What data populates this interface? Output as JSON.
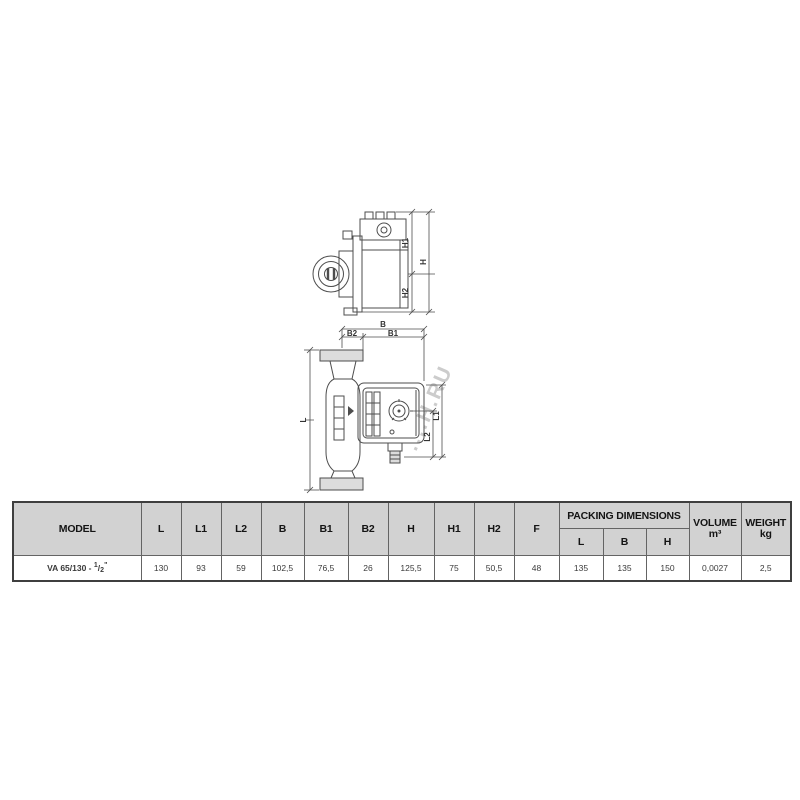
{
  "watermark": {
    "text": "....Н.RU"
  },
  "diagrams": {
    "side_view": {
      "h": "H",
      "h1": "H1",
      "h2": "H2"
    },
    "front_view": {
      "b": "B",
      "b1": "B1",
      "b2": "B2",
      "l": "L",
      "l1": "L1",
      "l2": "L2"
    }
  },
  "table": {
    "model_header": "MODEL",
    "dim_headers": [
      "L",
      "L1",
      "L2",
      "B",
      "B1",
      "B2",
      "H",
      "H1",
      "H2",
      "F"
    ],
    "packing_title": "PACKING DIMENSIONS",
    "packing_sub": [
      "L",
      "B",
      "H"
    ],
    "volume_header": [
      "VOLUME",
      "m³"
    ],
    "weight_header": [
      "WEIGHT",
      "kg"
    ],
    "row": {
      "model_prefix": "VA 65/130 - ",
      "model_sup": "1",
      "model_slash": "/",
      "model_sub": "2",
      "model_quote": "\"",
      "values": [
        "130",
        "93",
        "59",
        "102,5",
        "76,5",
        "26",
        "125,5",
        "75",
        "50,5",
        "48",
        "135",
        "135",
        "150",
        "0,0027",
        "2,5"
      ]
    }
  }
}
